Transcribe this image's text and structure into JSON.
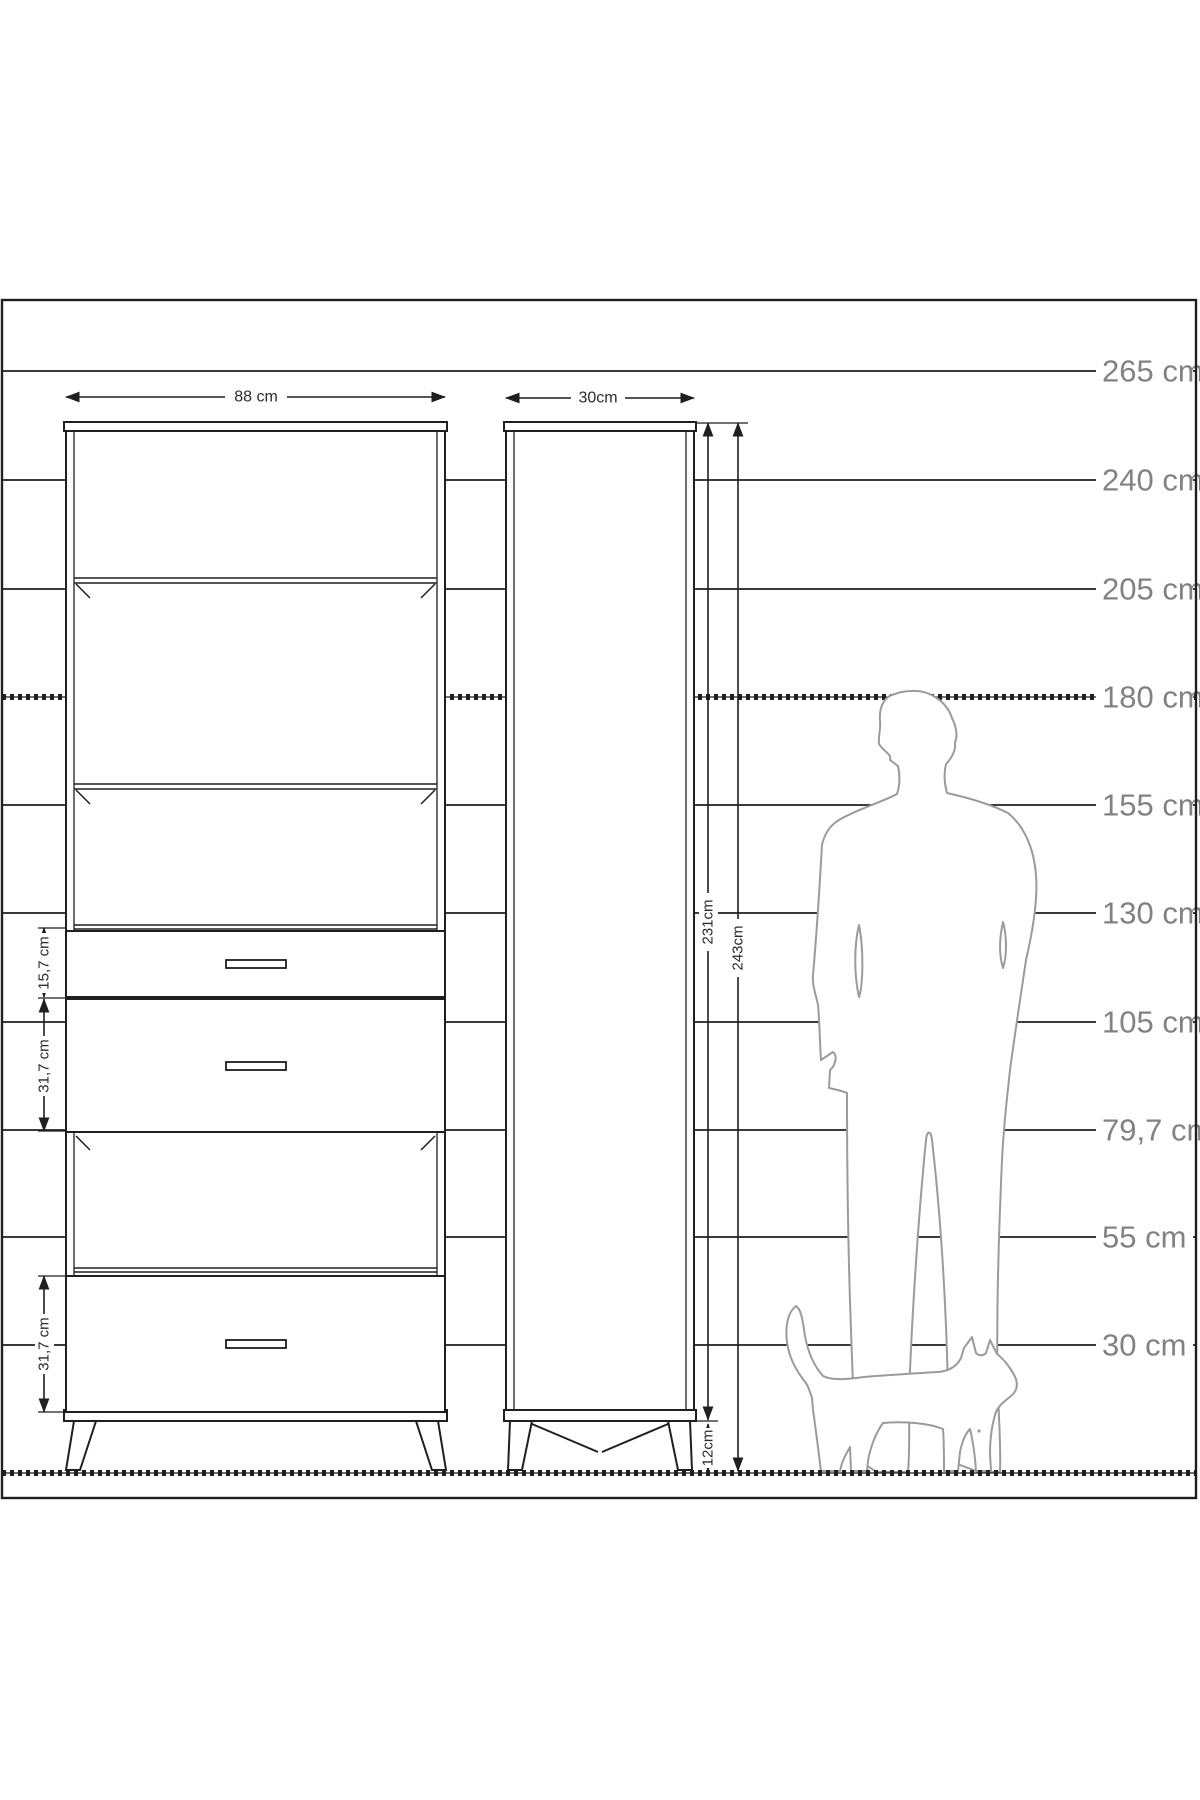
{
  "diagram_title": "furniture-dimension-diagram",
  "scale": {
    "labels": [
      "265 cm",
      "240 cm",
      "205 cm",
      "180 cm",
      "155 cm",
      "130 cm",
      "105 cm",
      "79,7 cm",
      "55 cm",
      "30 cm"
    ]
  },
  "front_view": {
    "width_label": "88 cm",
    "drawer_height_labels": [
      "15,7 cm",
      "31,7 cm",
      "31,7 cm"
    ]
  },
  "side_view": {
    "depth_label": "30cm",
    "body_height_label": "231cm",
    "total_height_label": "243cm",
    "leg_height_label": "12cm"
  },
  "colors": {
    "line": "#1f1f1f",
    "figure_outline": "#9b9b9b",
    "scale_label_gray": "#828282",
    "background": "#ffffff"
  }
}
